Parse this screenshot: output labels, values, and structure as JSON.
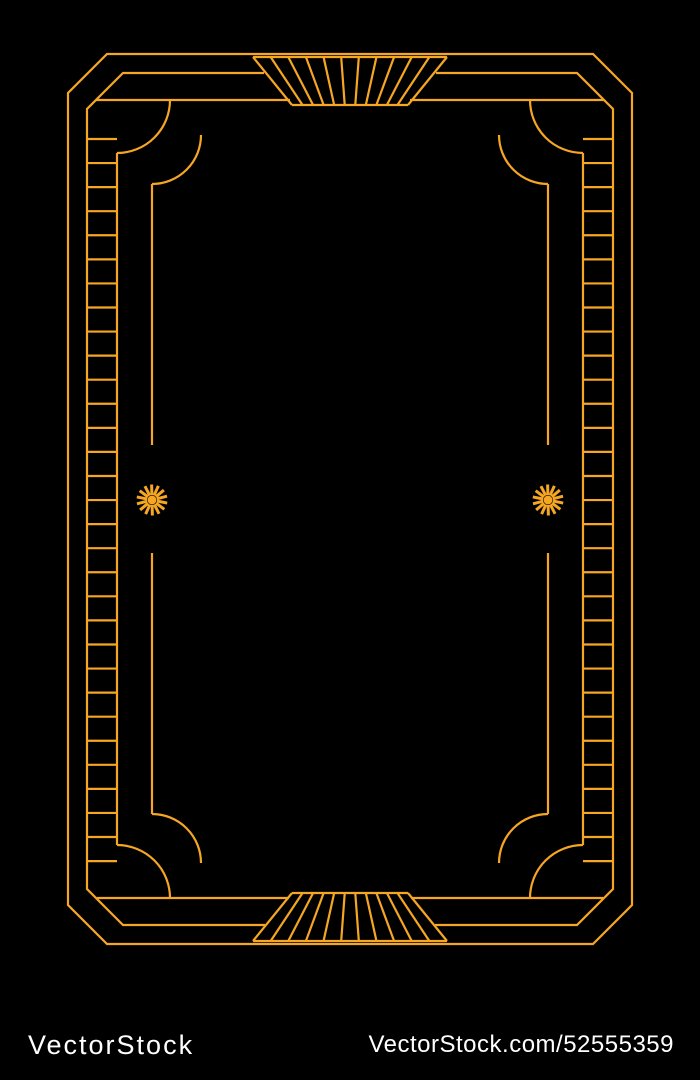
{
  "colors": {
    "background": "#000000",
    "frame_gold": "#F5A623",
    "watermark_text": "#FFFFFF",
    "watermark_bar_background": "#000000"
  },
  "artwork": {
    "ornaments": {
      "top_center": "sunburst-fan-icon",
      "bottom_center": "sunburst-fan-icon",
      "middle_left": "starburst-icon",
      "middle_right": "starburst-icon",
      "sides": "ladder-hatch-pattern",
      "corners": "concentric-quarter-arcs"
    }
  },
  "watermark": {
    "brand": "VectorStock",
    "url_text": "VectorStock.com/52555359"
  }
}
